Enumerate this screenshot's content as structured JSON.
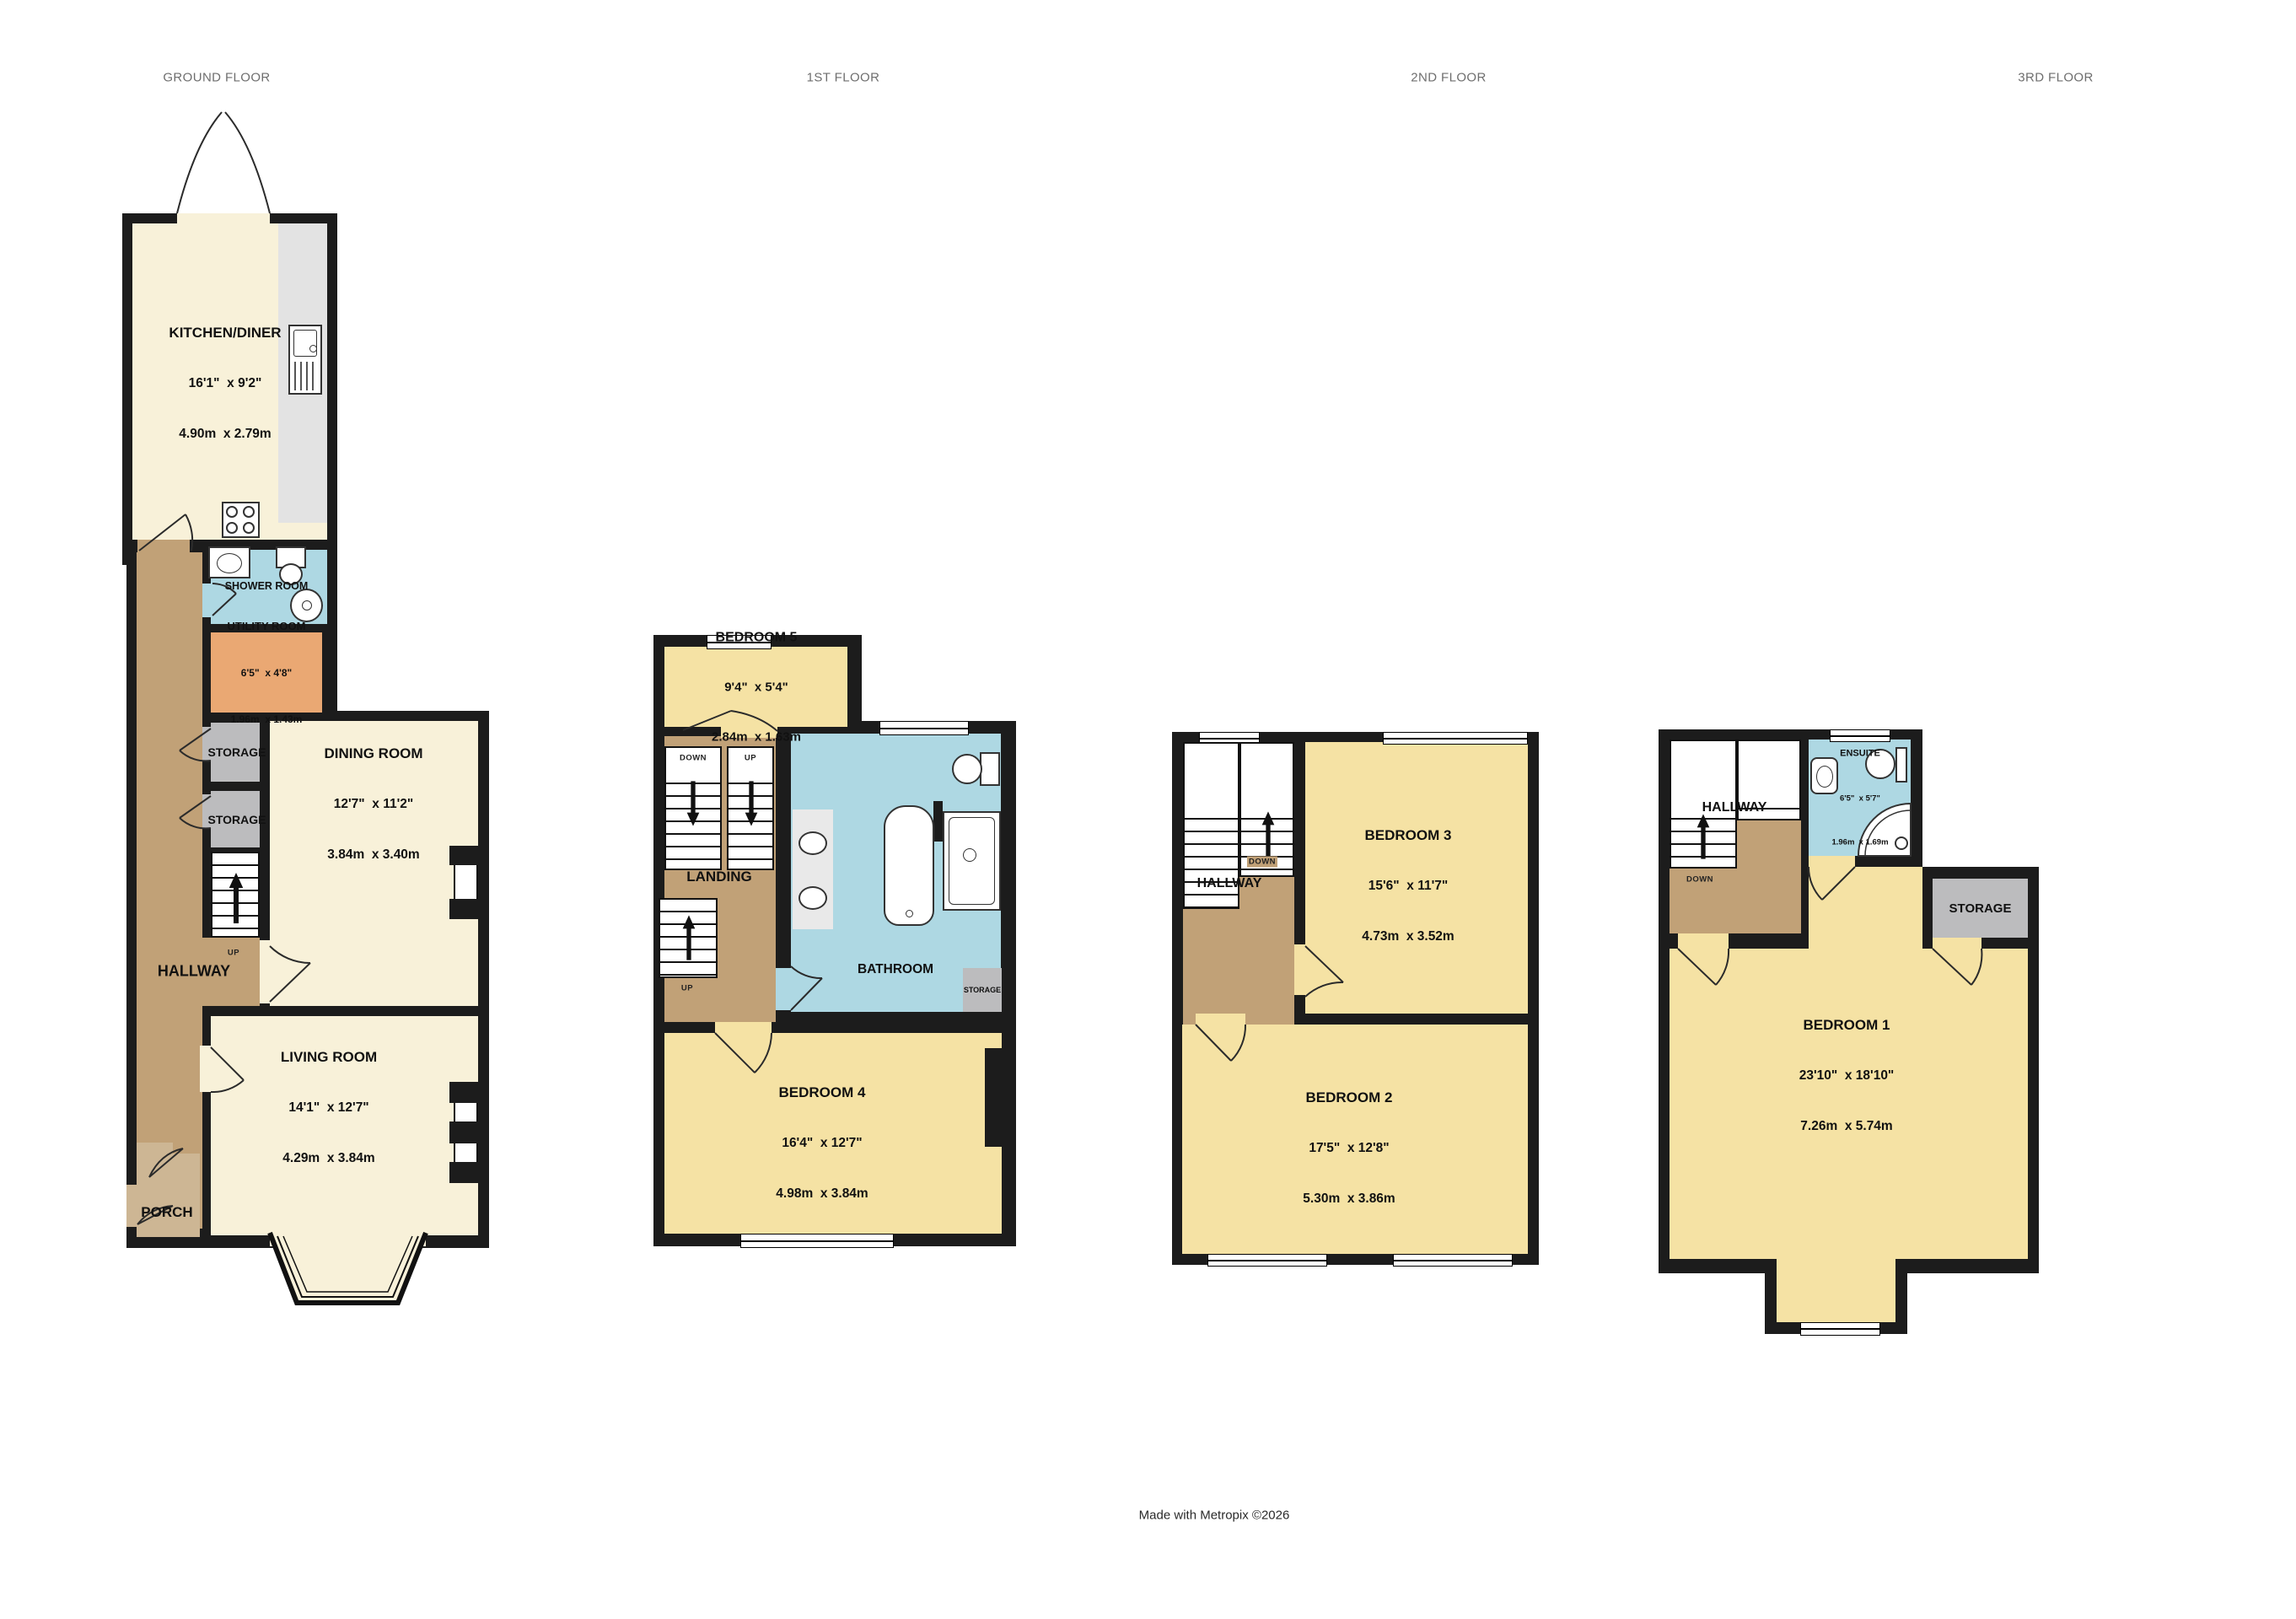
{
  "footer": "Made with Metropix ©2026",
  "colors": {
    "wall": "#1c1c1c",
    "reception_cream": "#f8f1d9",
    "bedroom_yellow": "#f5e2a4",
    "hallway_brown": "#c1a177",
    "porch_brown": "#cdb694",
    "wet_room_blue": "#aed8e3",
    "utility_orange": "#eaa873",
    "storage_gray": "#bcbcbe",
    "worktop_gray": "#e3e3e3"
  },
  "floors": {
    "ground": {
      "title": "GROUND FLOOR",
      "kitchen": {
        "name": "KITCHEN/DINER",
        "imperial": "16'1\"  x 9'2\"",
        "metric": "4.90m  x 2.79m"
      },
      "shower": {
        "name": "SHOWER ROOM"
      },
      "utility": {
        "name": "UTILITY ROOM",
        "imperial": "6'5\"  x 4'8\"",
        "metric": "1.96m  x 1.43m"
      },
      "storage1": {
        "name": "STORAGE"
      },
      "storage2": {
        "name": "STORAGE"
      },
      "dining": {
        "name": "DINING ROOM",
        "imperial": "12'7\"  x 11'2\"",
        "metric": "3.84m  x 3.40m"
      },
      "hallway": {
        "name": "HALLWAY",
        "up": "UP"
      },
      "living": {
        "name": "LIVING ROOM",
        "imperial": "14'1\"  x 12'7\"",
        "metric": "4.29m  x 3.84m"
      },
      "porch": {
        "name": "PORCH"
      }
    },
    "first": {
      "title": "1ST FLOOR",
      "bedroom5": {
        "name": "BEDROOM 5",
        "imperial": "9'4\"  x 5'4\"",
        "metric": "2.84m  x 1.63m"
      },
      "landing": {
        "name": "LANDING",
        "down": "DOWN",
        "up": "UP",
        "up2": "UP"
      },
      "bathroom": {
        "name": "BATHROOM"
      },
      "storage": {
        "name": "STORAGE"
      },
      "bedroom4": {
        "name": "BEDROOM 4",
        "imperial": "16'4\"  x 12'7\"",
        "metric": "4.98m  x 3.84m"
      }
    },
    "second": {
      "title": "2ND FLOOR",
      "hallway": {
        "name": "HALLWAY",
        "down": "DOWN"
      },
      "bedroom3": {
        "name": "BEDROOM 3",
        "imperial": "15'6\"  x 11'7\"",
        "metric": "4.73m  x 3.52m"
      },
      "bedroom2": {
        "name": "BEDROOM 2",
        "imperial": "17'5\"  x 12'8\"",
        "metric": "5.30m  x 3.86m"
      }
    },
    "third": {
      "title": "3RD FLOOR",
      "hallway": {
        "name": "HALLWAY",
        "down": "DOWN"
      },
      "ensuite": {
        "name": "ENSUITE",
        "imperial": "6'5\"  x 5'7\"",
        "metric": "1.96m  x 1.69m"
      },
      "storage": {
        "name": "STORAGE"
      },
      "bedroom1": {
        "name": "BEDROOM 1",
        "imperial": "23'10\"  x 18'10\"",
        "metric": "7.26m  x 5.74m"
      }
    }
  }
}
